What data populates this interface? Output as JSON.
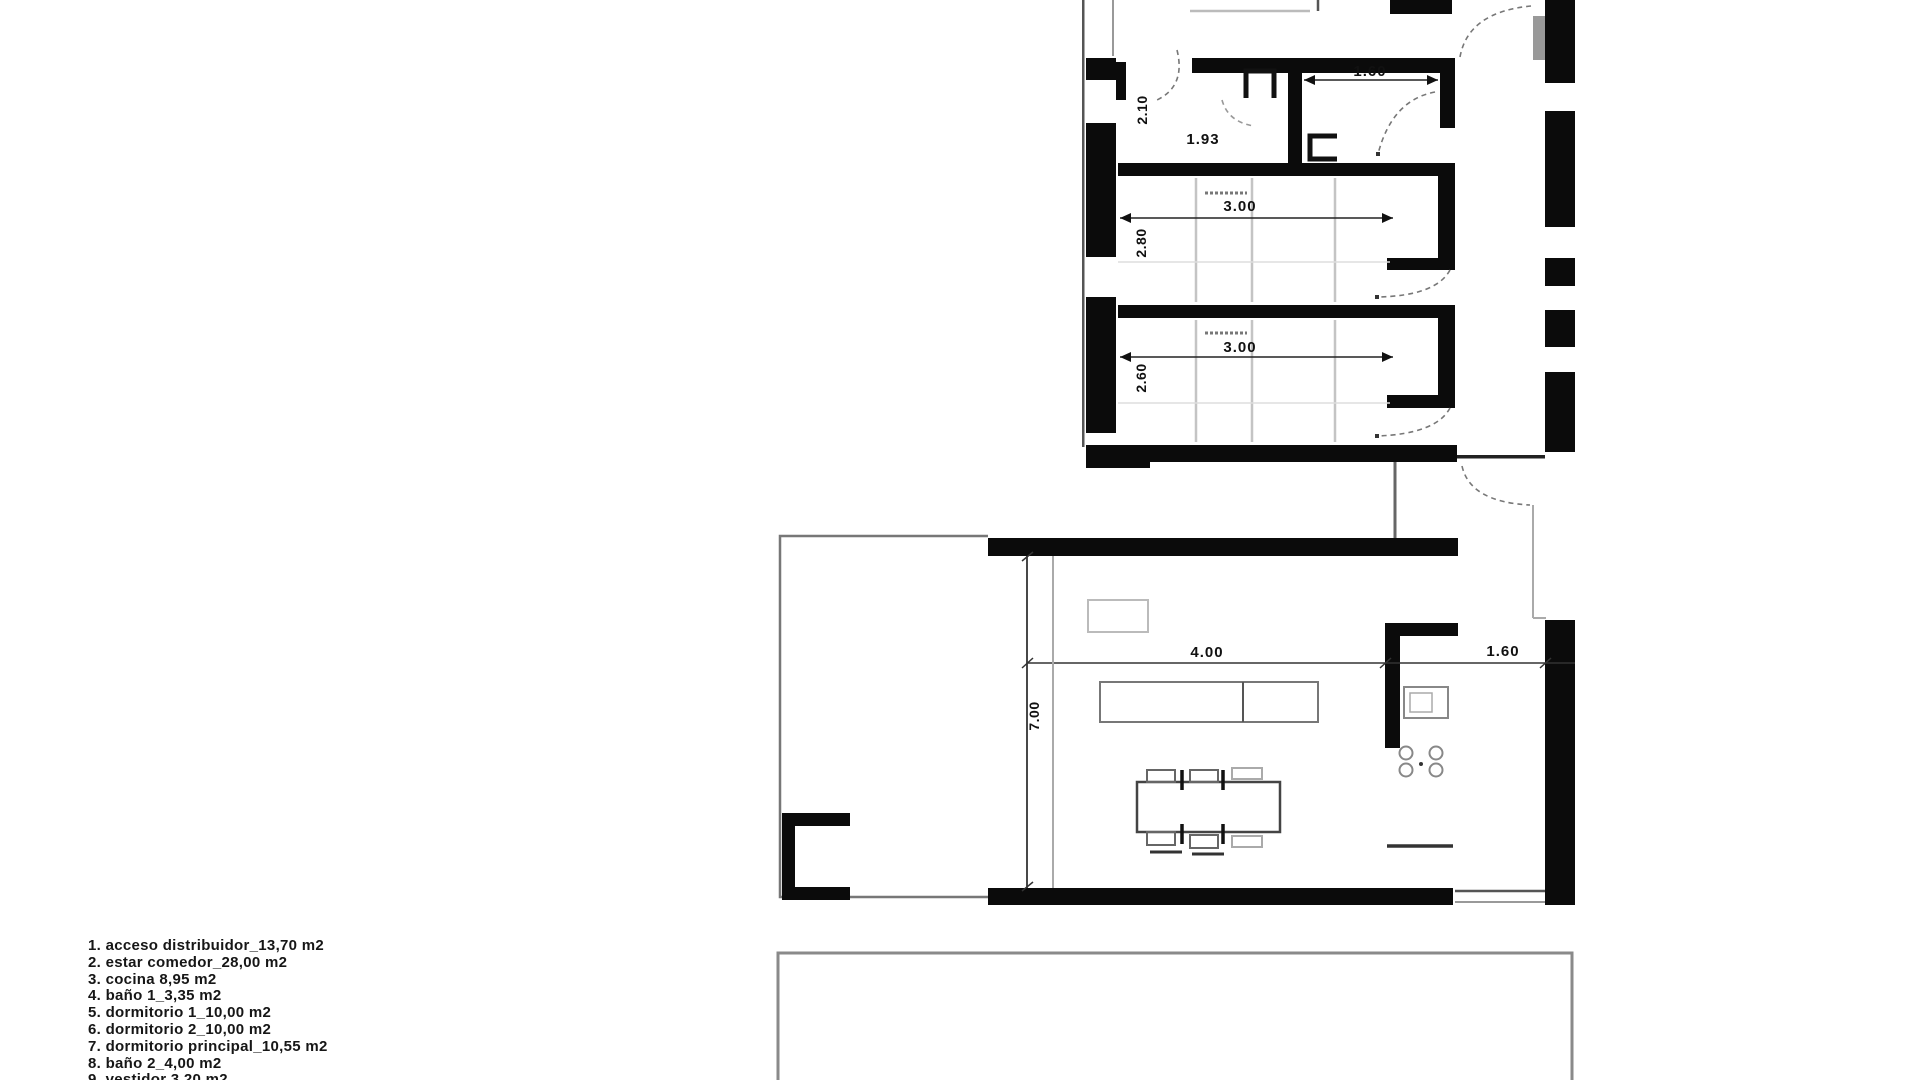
{
  "legend": {
    "items": [
      "1. acceso distribuidor_13,70 m2",
      "2. estar comedor_28,00 m2",
      "3. cocina 8,95 m2",
      "4. baño 1_3,35 m2",
      "5. dormitorio 1_10,00 m2",
      "6. dormitorio 2_10,00 m2",
      "7. dormitorio principal_10,55 m2",
      "8. baño 2_4,00 m2",
      "9. vestidor 3,20 m2"
    ]
  },
  "dimensions": {
    "upper": {
      "bath1_width": "2.10",
      "bath1_length": "1.93",
      "bath2_width": "1.60",
      "bedroom1_width": "3.00",
      "bedroom1_depth": "2.80",
      "bedroom2_width": "3.00",
      "bedroom2_depth": "2.60"
    },
    "lower": {
      "living_width": "4.00",
      "kitchen_width": "1.60",
      "living_depth": "7.00"
    }
  },
  "colors": {
    "wall": "#0b0b0b",
    "thin_line": "#555555",
    "light_line": "#bbbbbb",
    "text": "#111111"
  }
}
